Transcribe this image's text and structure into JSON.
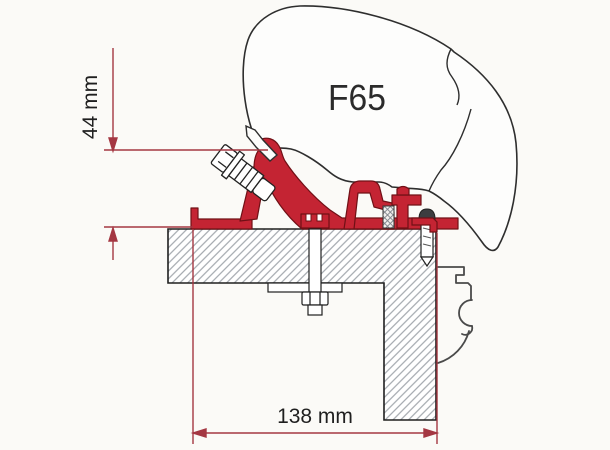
{
  "diagram": {
    "title": "Awning adapter cross-section",
    "product_label": "F65",
    "dimension_vertical": {
      "label": "44 mm"
    },
    "dimension_horizontal": {
      "label": "138 mm"
    },
    "colors": {
      "adapter_red": "#c42433",
      "adapter_red_outline": "#701016",
      "dimension_red": "#a43742",
      "case_outline": "#2e2e2e",
      "hatch_gray": "#9aa0a6",
      "text_black": "#1f1f1f",
      "background": "#fbfaf7"
    }
  }
}
